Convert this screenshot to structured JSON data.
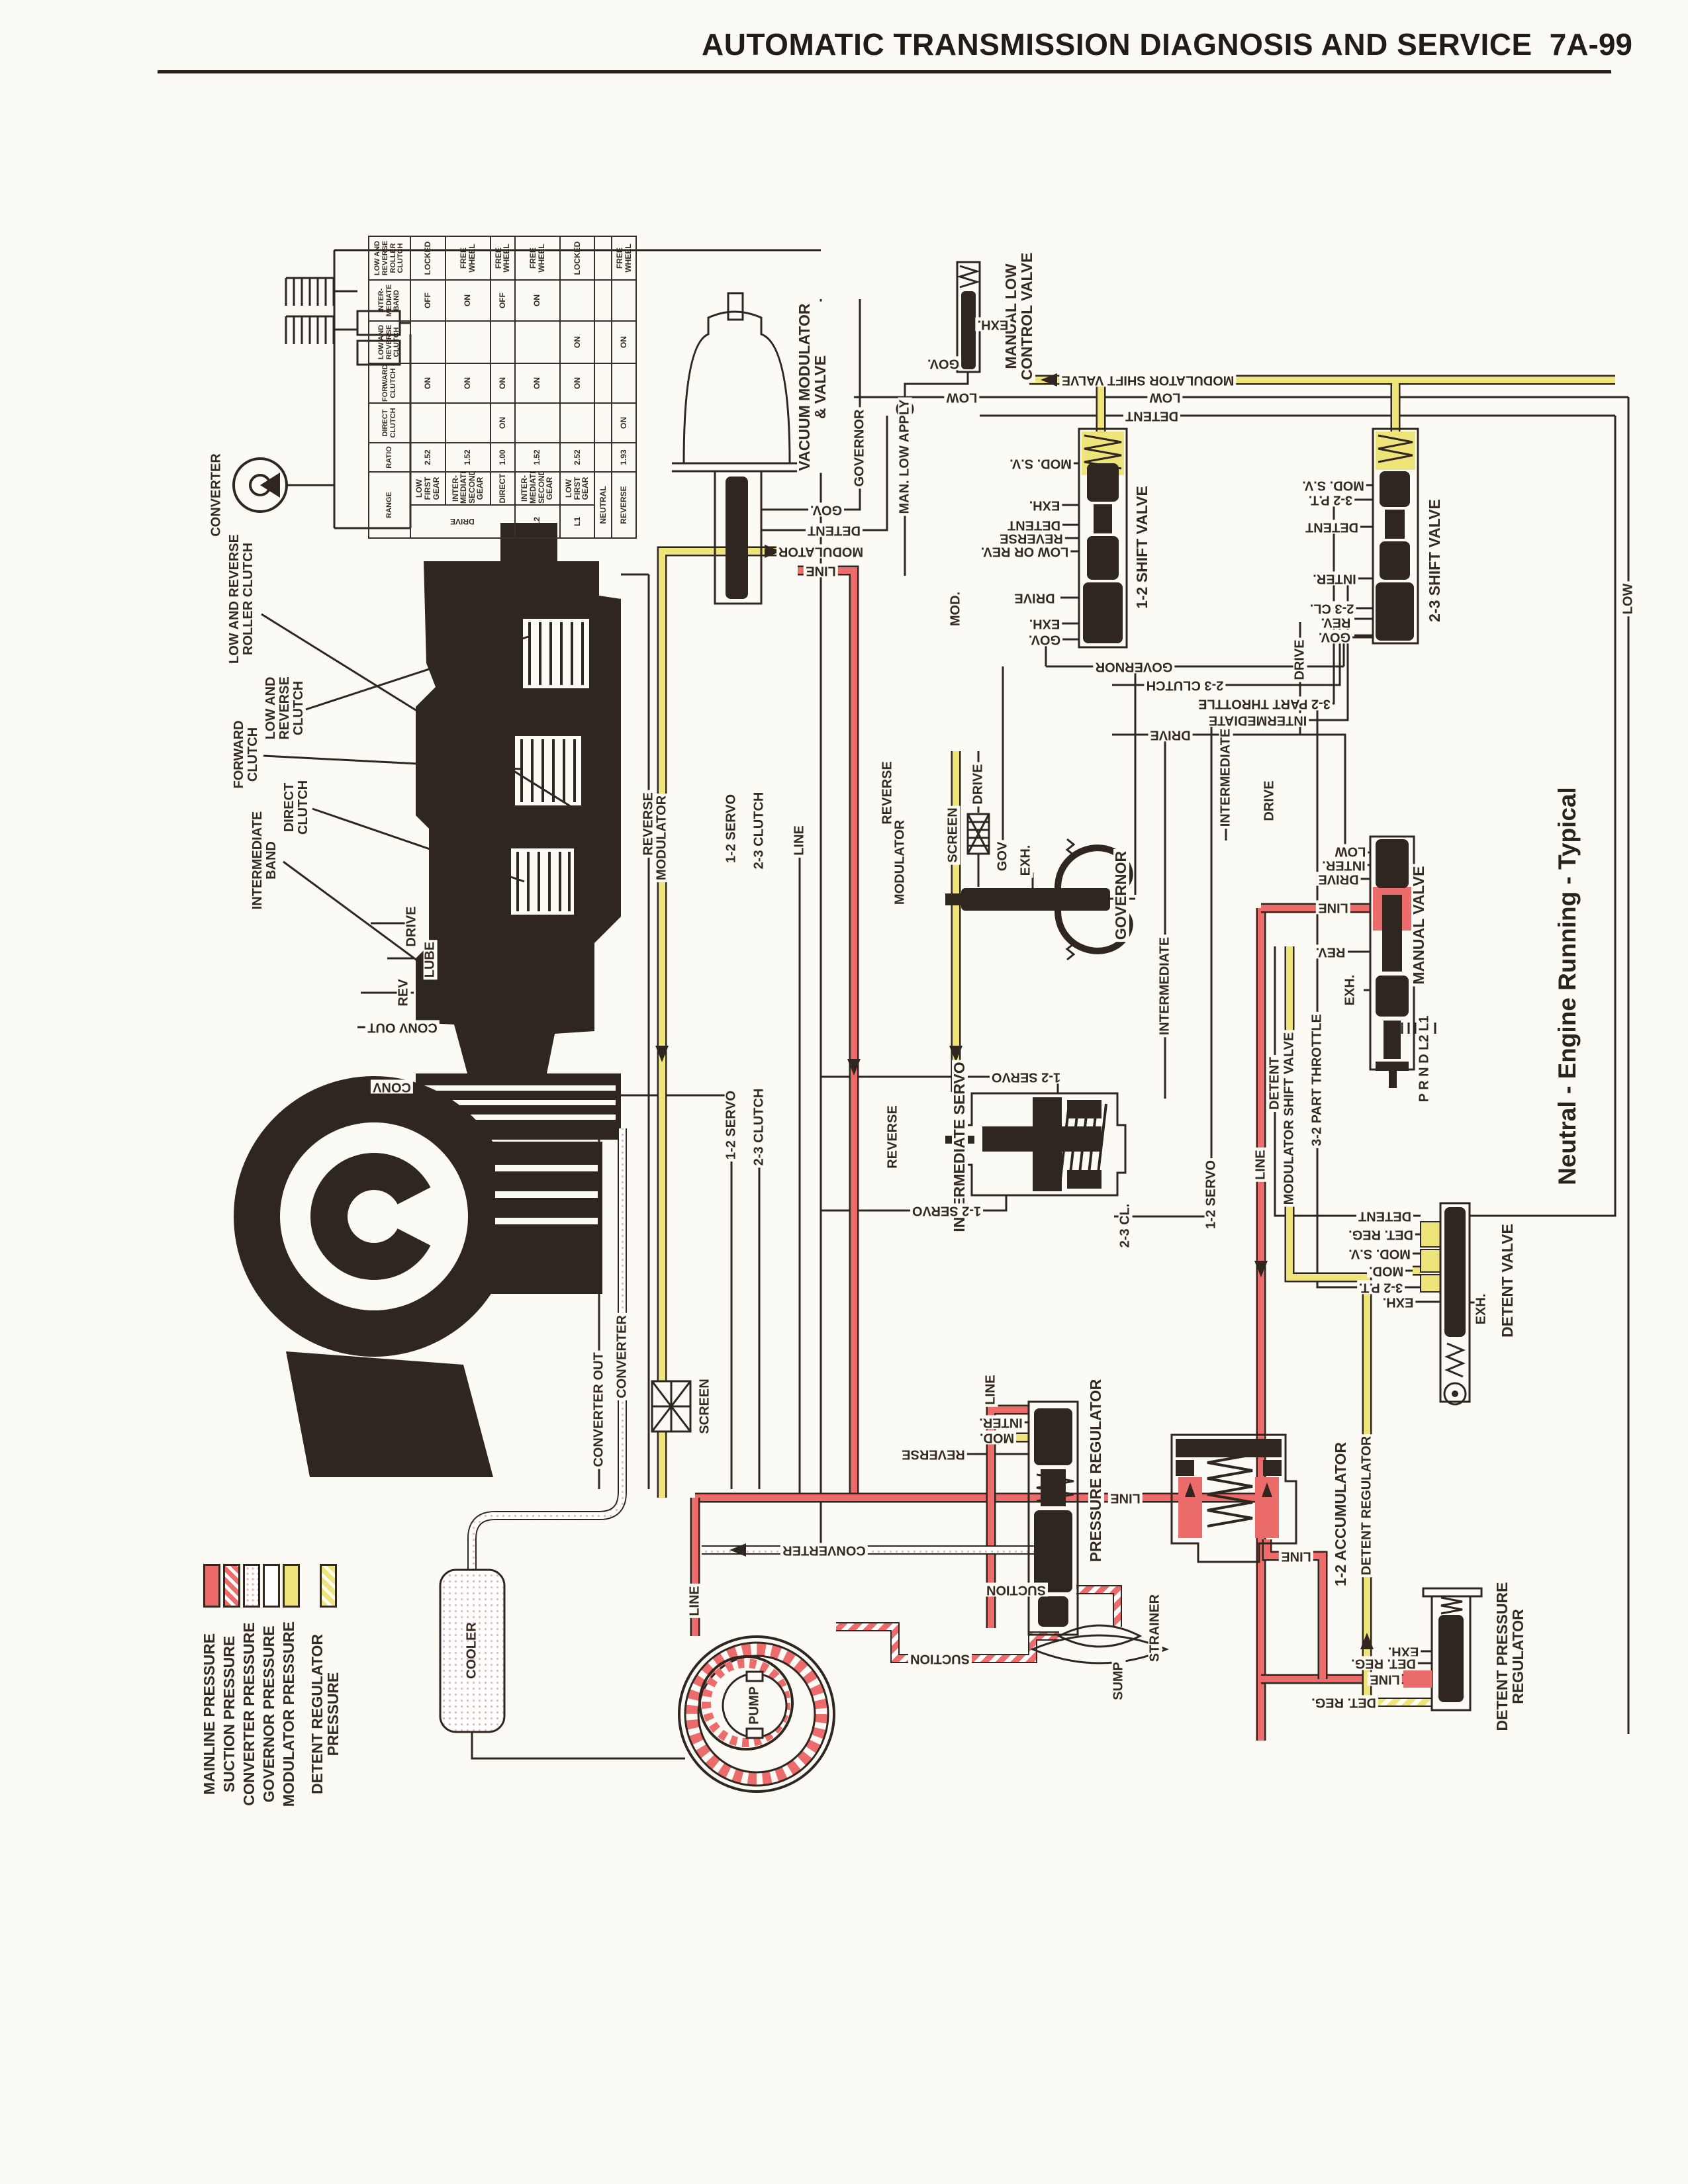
{
  "header": {
    "title": "AUTOMATIC TRANSMISSION DIAGNOSIS AND SERVICE",
    "page_number": "7A-99"
  },
  "caption": "Neutral - Engine Running - Typical",
  "colors": {
    "paper": "#fcfaf4",
    "ink": "#2e261f",
    "mainline_red": "#ec6b6b",
    "modulator_yellow": "#efe47a",
    "detent_regulator_pale": "#f5efbe",
    "converter_pink_dot": "#efb6b6"
  },
  "legend": {
    "items": [
      {
        "label": "MAINLINE PRESSURE"
      },
      {
        "label": "SUCTION PRESSURE"
      },
      {
        "label": "CONVERTER PRESSURE"
      },
      {
        "label": "GOVERNOR PRESSURE"
      },
      {
        "label": "MODULATOR PRESSURE"
      },
      {
        "label": "DETENT REGULATOR\nPRESSURE"
      }
    ]
  },
  "table": {
    "headers": [
      "RANGE",
      "RATIO",
      "DIRECT\nCLUTCH",
      "FORWARD\nCLUTCH",
      "LOW AND\nREVERSE\nCLUTCH",
      "INTER-\nMEDIATE\nBAND",
      "LOW AND\nREVERSE\nROLLER\nCLUTCH"
    ],
    "drive_group_label": "DRIVE",
    "rows": [
      {
        "range": "",
        "gear": "LOW\nFIRST\nGEAR",
        "ratio": "2.52",
        "direct": "",
        "forward": "ON",
        "low_reverse": "",
        "band": "OFF",
        "roller": "LOCKED"
      },
      {
        "range": "",
        "gear": "INTER-\nMEDIATE\nSECOND\nGEAR",
        "ratio": "1.52",
        "direct": "",
        "forward": "ON",
        "low_reverse": "",
        "band": "ON",
        "roller": "FREE\nWHEEL"
      },
      {
        "range": "",
        "gear": "DIRECT",
        "ratio": "1.00",
        "direct": "ON",
        "forward": "ON",
        "low_reverse": "",
        "band": "OFF",
        "roller": "FREE\nWHEEL"
      },
      {
        "range": "L2",
        "gear": "INTER-\nMEDIATE\nSECOND\nGEAR",
        "ratio": "1.52",
        "direct": "",
        "forward": "ON",
        "low_reverse": "",
        "band": "ON",
        "roller": "FREE\nWHEEL"
      },
      {
        "range": "L1",
        "gear": "LOW\nFIRST\nGEAR",
        "ratio": "2.52",
        "direct": "",
        "forward": "ON",
        "low_reverse": "ON",
        "band": "",
        "roller": "LOCKED"
      },
      {
        "range": "NEUTRAL",
        "gear": "",
        "ratio": "",
        "direct": "",
        "forward": "",
        "low_reverse": "",
        "band": "",
        "roller": ""
      },
      {
        "range": "REVERSE",
        "gear": "",
        "ratio": "1.93",
        "direct": "ON",
        "forward": "",
        "low_reverse": "ON",
        "band": "",
        "roller": "FREE\nWHEEL"
      }
    ]
  },
  "callouts": [
    {
      "label": "LOW AND REVERSE\nROLLER CLUTCH"
    },
    {
      "label": "LOW AND\nREVERSE\nCLUTCH"
    },
    {
      "label": "FORWARD\nCLUTCH"
    },
    {
      "label": "DIRECT\nCLUTCH"
    },
    {
      "label": "INTERMEDIATE\nBAND"
    }
  ],
  "components": {
    "converter_schematic": {
      "title": "CONVERTER"
    },
    "vacuum_modulator": {
      "title": "VACUUM MODULATOR\n& VALVE",
      "ports": [
        "GOV.",
        "DETENT",
        "MODULATOR",
        "LINE"
      ]
    },
    "manual_low_control": {
      "title": "MANUAL LOW\nCONTROL VALVE",
      "ports": [
        "EXH.",
        "GOV."
      ]
    },
    "shift_12": {
      "title": "1-2 SHIFT VALVE",
      "ports": [
        "MOD. S.V.",
        "EXH.",
        "DETENT",
        "REVERSE",
        "LOW OR REV.",
        "DRIVE",
        "EXH.",
        "GOV."
      ]
    },
    "shift_23": {
      "title": "2-3 SHIFT VALVE",
      "ports": [
        "MOD. S.V.",
        "3-2 P.T.",
        "DETENT",
        "INTER.",
        "2-3 CL.",
        "REV.",
        "GOV."
      ]
    },
    "governor": {
      "title": "GOVERNOR",
      "ports": [
        "DRIVE",
        "SCREEN",
        "GOV",
        "EXH."
      ]
    },
    "manual_valve": {
      "title": "MANUAL VALVE",
      "ports": [
        "LOW",
        "INTER.",
        "DRIVE",
        "LINE",
        "REV.",
        "EXH."
      ],
      "quadrant": "P R N D L2 L1"
    },
    "intermediate_servo": {
      "title": "INTERMEDIATE SERVO",
      "ports": [
        "1-2 SERVO",
        "1-2 SERVO",
        "2-3 CL."
      ]
    },
    "detent_valve": {
      "title": "DETENT VALVE",
      "ports": [
        "DETENT",
        "DET. REG.",
        "MOD. S.V.",
        "MOD.",
        "3-2 P.T.",
        "EXH.",
        "EXH."
      ]
    },
    "pressure_regulator": {
      "title": "PRESSURE REGULATOR",
      "ports": [
        "LINE",
        "INTER.",
        "MOD.",
        "REVERSE",
        "SUCTION"
      ],
      "sump": "SUMP",
      "strainer": "STRAINER"
    },
    "accumulator_12": {
      "title": "1-2 ACCUMULATOR",
      "ports": [
        "LINE"
      ]
    },
    "detent_pressure_regulator": {
      "title": "DETENT PRESSURE\nREGULATOR",
      "ports": [
        "EXH.",
        "DET. REG.",
        "LINE",
        "DET. REG."
      ]
    },
    "pump": {
      "title": "PUMP"
    },
    "cooler": {
      "title": "COOLER"
    }
  },
  "line_labels": {
    "msv_top": "MODULATOR SHIFT VALVE",
    "low_a": "LOW",
    "low_b": "LOW",
    "detent_a": "DETENT",
    "governor_a": "GOVERNOR",
    "man_low_apply": "MAN. LOW APPLY",
    "mod_a": "MOD.",
    "governor_b": "GOVERNOR",
    "cl23_a": "2-3 CLUTCH",
    "pt32_a": "3-2 PART THROTTLE",
    "inter_a": "INTERMEDIATE",
    "drive_a": "DRIVE",
    "reverse_a": "REVERSE",
    "modulator_a": "MODULATOR",
    "servo_a": "1-2 SERVO",
    "cl23_b": "2-3 CLUTCH",
    "line_a": "LINE",
    "reverse_b": "REVERSE",
    "modulator_b": "MODULATOR",
    "drive_b": "DRIVE",
    "low_c": "LOW",
    "inter_b": "INTERMEDIATE",
    "drive_c": "DRIVE",
    "detent_b": "DETENT",
    "msv_b": "MODULATOR SHIFT VALVE",
    "pt32_b": "3-2 PART THROTTLE",
    "line_b": "LINE",
    "servo_b": "1-2 SERVO",
    "reverse_c": "REVERSE",
    "servo_c": "1-2 SERVO",
    "cl23_c": "2-3 CLUTCH",
    "drive_d": "DRIVE",
    "lube": "LUBE",
    "rev": "REV",
    "conv_out": "CONV OUT",
    "conv": "CONV",
    "converter_out": "CONVERTER OUT",
    "converter_a": "CONVERTER",
    "detent_reg": "DETENT REGULATOR",
    "line_d": "LINE",
    "line_e": "LINE",
    "converter_b": "CONVERTER",
    "suction_a": "SUCTION",
    "screen_a": "SCREEN",
    "inter_c": "INTERMEDIATE"
  }
}
